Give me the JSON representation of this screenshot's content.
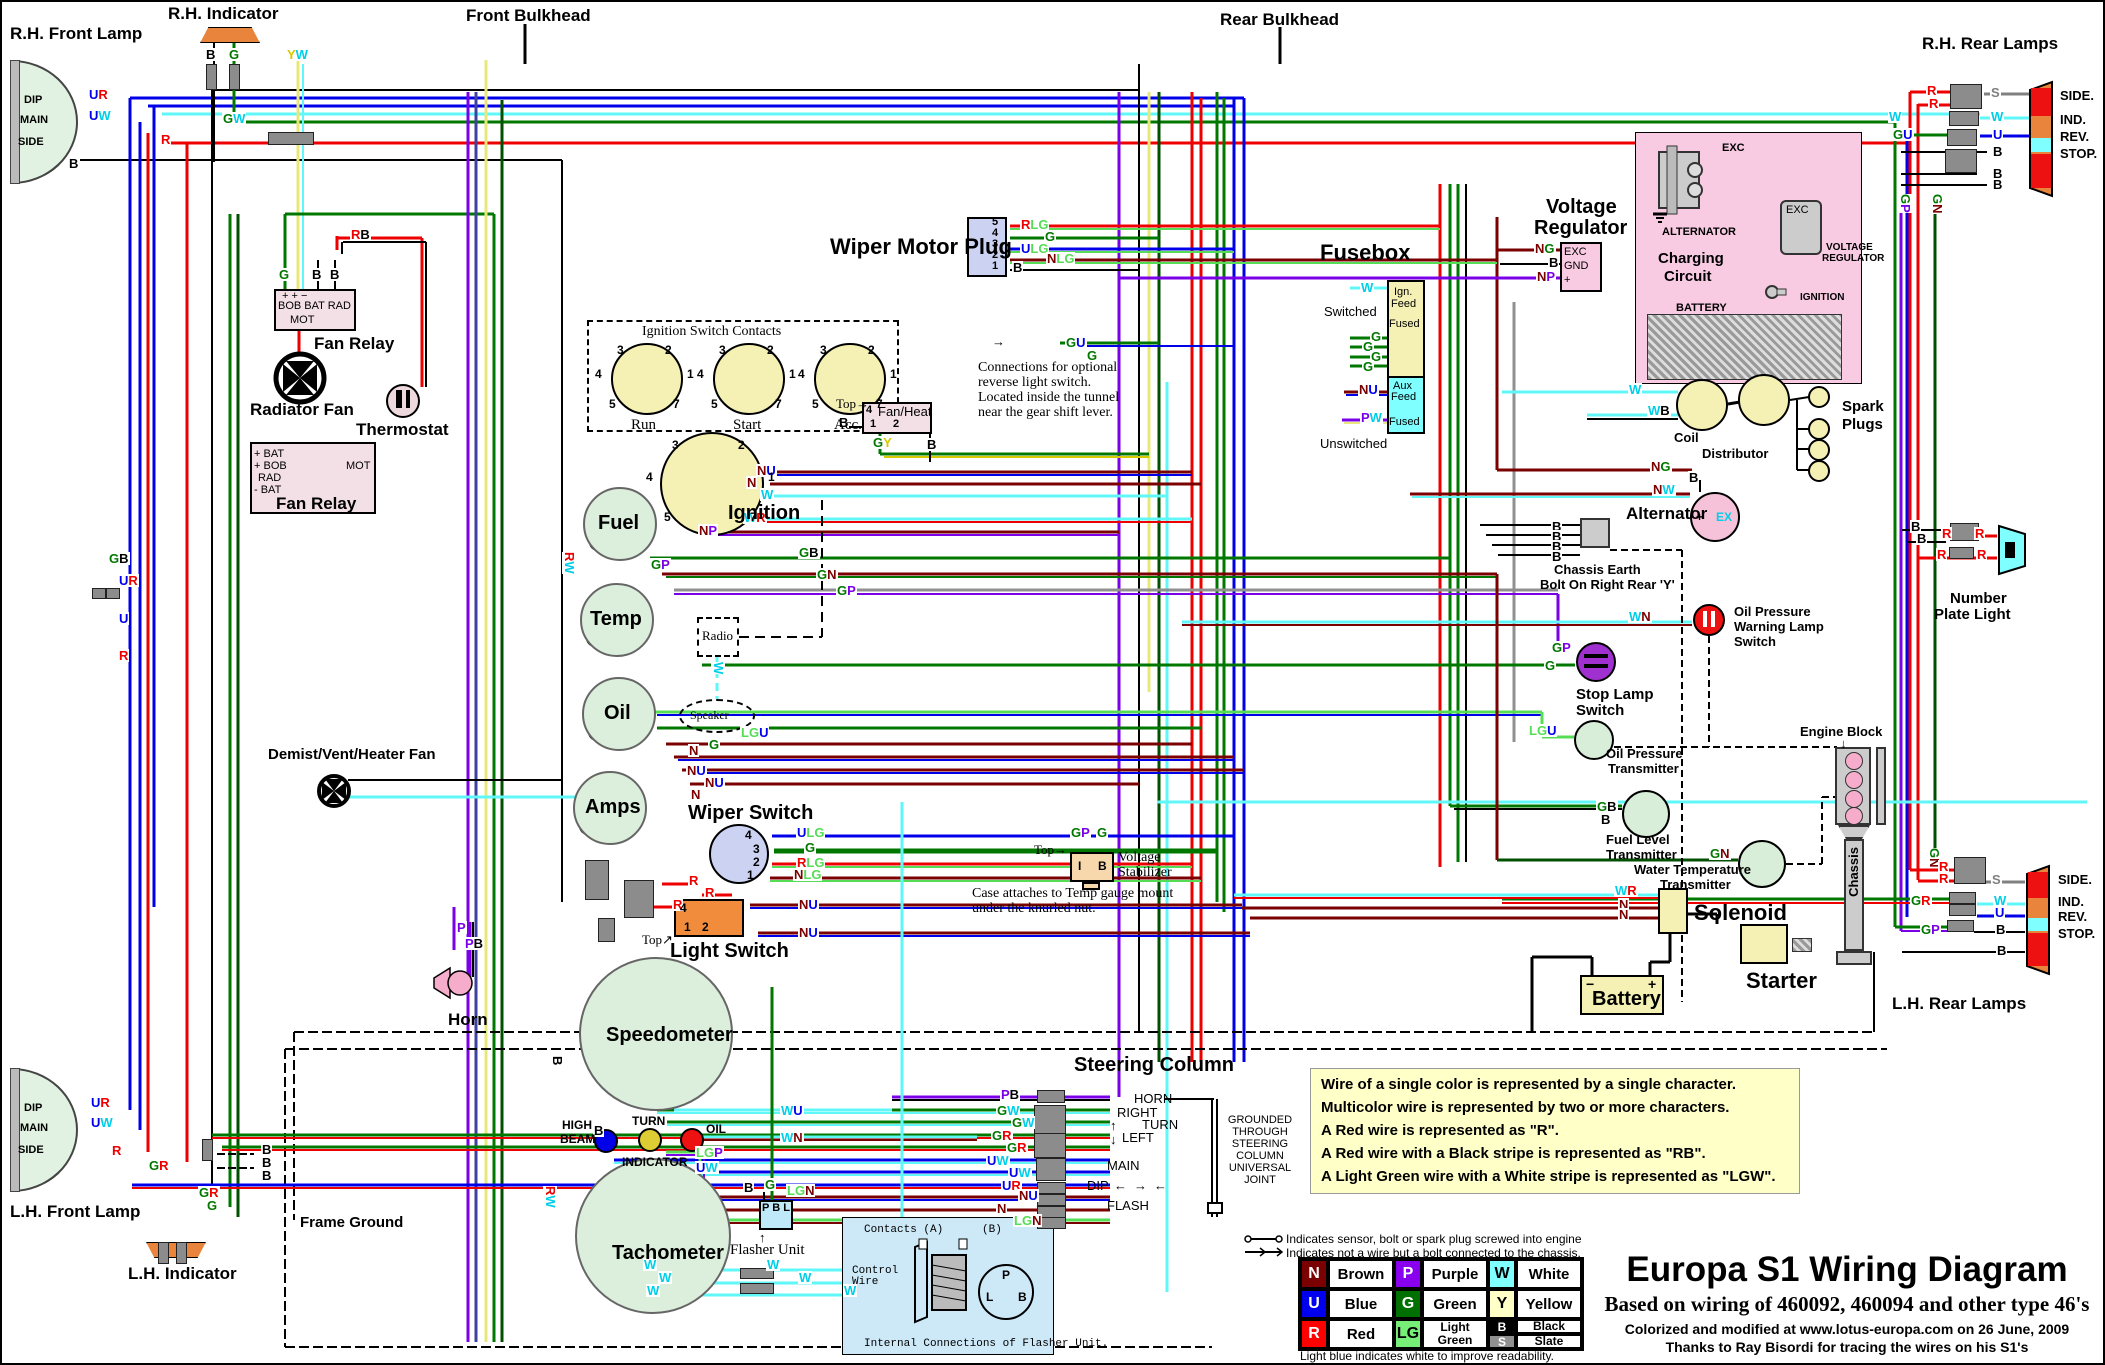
{
  "titles": {
    "main": "Europa S1 Wiring Diagram",
    "sub": "Based on wiring of 460092, 460094 and other type 46's",
    "credit1": "Colorized and modified at www.lotus-europa.com on 26 June, 2009",
    "credit2": "Thanks to Ray Bisordi for tracing the wires on his S1's"
  },
  "notes": {
    "wirebox": [
      "Wire of a single color is represented by a single character.",
      "Multicolor wire is represented by two or more characters.",
      "A Red wire is represented as \"R\".",
      "A Red wire with a Black stripe is represented as \"RB\".",
      "A Light Green wire with a White stripe is represented as \"LGW\"."
    ],
    "legend1": "Indicates sensor, bolt or spark plug screwed into engine",
    "legend2": "Indicates not a wire but a bolt connected to the chassis.",
    "lightblue": "Light blue indicates white to improve readability.",
    "reverse1": "Connections for optional",
    "reverse2": "reverse light switch.",
    "reverse3": "Located inside the tunnel",
    "reverse4": "near the gear shift lever.",
    "stab1": "Case attaches to Temp gauge mount",
    "stab2": "under the knurled nut.",
    "grounded": [
      "GROUNDED",
      "THROUGH",
      "STEERING",
      "COLUMN",
      "UNIVERSAL",
      "JOINT"
    ],
    "flasher_int_title": "Internal Connections of Flasher Unit.",
    "contacts_a": "Contacts (A)",
    "contacts_b": "(B)",
    "control1": "Control",
    "control2": "Wire"
  },
  "legend": {
    "items": [
      {
        "code": "N",
        "name": "Brown",
        "bg": "#7B0000",
        "fg": "#FFFFFF"
      },
      {
        "code": "P",
        "name": "Purple",
        "bg": "#8800EE",
        "fg": "#FFFFFF"
      },
      {
        "code": "W",
        "name": "White",
        "bg": "#7FFFFF",
        "fg": "#000000"
      },
      {
        "code": "U",
        "name": "Blue",
        "bg": "#0000EE",
        "fg": "#FFFFFF"
      },
      {
        "code": "G",
        "name": "Green",
        "bg": "#007000",
        "fg": "#FFFFFF"
      },
      {
        "code": "Y",
        "name": "Yellow",
        "bg": "#FFFFC8",
        "fg": "#000000"
      },
      {
        "code": "R",
        "name": "Red",
        "bg": "#FF0000",
        "fg": "#FFFFFF"
      },
      {
        "code": "LG",
        "name": "Light Green",
        "bg": "#77EE77",
        "fg": "#000000"
      },
      {
        "code": "B",
        "name": "Black",
        "bg": "#000000",
        "fg": "#FFFFFF"
      },
      {
        "code": "S",
        "name": "Slate",
        "bg": "#909090",
        "fg": "#FFFFFF"
      }
    ]
  },
  "components": {
    "rh_front_lamp": "R.H. Front Lamp",
    "lh_front_lamp": "L.H. Front Lamp",
    "rh_indicator": "R.H. Indicator",
    "lh_indicator": "L.H. Indicator",
    "front_bulkhead": "Front Bulkhead",
    "rear_bulkhead": "Rear Bulkhead",
    "rh_rear_lamps": "R.H. Rear Lamps",
    "lh_rear_lamps": "L.H. Rear Lamps",
    "fan_relay": "Fan Relay",
    "radiator_fan": "Radiator Fan",
    "thermostat": "Thermostat",
    "fr_row1": "+   +   −",
    "fr_row2": "BOB BAT  RAD",
    "fr_mot": "MOT",
    "fr2_l1": "+ BAT",
    "fr2_l2": "+ BOB",
    "fr2_l3": "RAD",
    "fr2_l4": "- BAT",
    "fr2_mot": "MOT",
    "fr2_label": "Fan Relay",
    "demist": "Demist/Vent/Heater Fan",
    "horn": "Horn",
    "frame_ground": "Frame Ground",
    "ignition": "Ignition",
    "fuel": "Fuel",
    "temp": "Temp",
    "oil": "Oil",
    "amps": "Amps",
    "radio": "Radio",
    "speaker": "Speaker",
    "wiper_switch": "Wiper Switch",
    "light_switch": "Light Switch",
    "voltage_stab1": "Voltage",
    "voltage_stab2": "Stabilizer",
    "speedometer": "Speedometer",
    "tachometer": "Tachometer",
    "high1": "HIGH",
    "high2": "BEAM",
    "turn": "TURN",
    "oil_ind": "OIL",
    "indicator": "INDICATOR",
    "flasher_unit": "Flasher Unit",
    "wiper_motor_plug": "Wiper Motor Plug",
    "fan_heat": "Fan/Heat",
    "top": "Top",
    "steering_column": "Steering Column",
    "sc_horn": "HORN",
    "sc_right": "RIGHT",
    "sc_turn": "TURN",
    "sc_left": "LEFT",
    "sc_main": "MAIN",
    "sc_dip": "DIP",
    "sc_flash": "FLASH",
    "fusebox": "Fusebox",
    "fb_ign": "Ign.",
    "fb_feed": "Feed",
    "fb_fused": "Fused",
    "fb_aux": "Aux",
    "switched": "Switched",
    "unswitched": "Unswitched",
    "voltage_regulator1": "Voltage",
    "voltage_regulator2": "Regulator",
    "charging1": "Charging",
    "charging2": "Circuit",
    "cc_alternator": "ALTERNATOR",
    "cc_vreg1": "VOLTAGE",
    "cc_vreg2": "REGULATOR",
    "cc_ignition": "IGNITION",
    "cc_battery": "BATTERY",
    "cc_exc": "EXC",
    "coil": "Coil",
    "distributor": "Distributor",
    "spark1": "Spark",
    "spark2": "Plugs",
    "alternator": "Alternator",
    "chassis_earth1": "Chassis Earth",
    "chassis_earth2": "Bolt On Right Rear 'Y'",
    "opw1": "Oil Pressure",
    "opw2": "Warning Lamp",
    "opw3": "Switch",
    "stop1": "Stop Lamp",
    "stop2": "Switch",
    "opt1": "Oil Pressure",
    "opt2": "Transmitter",
    "flt1": "Fuel Level",
    "flt2": "Transmitter",
    "wtt1": "Water Temperature",
    "wtt2": "Transmitter",
    "engine_block": "Engine Block",
    "chassis": "Chassis",
    "solenoid": "Solenoid",
    "starter": "Starter",
    "battery": "Battery",
    "np1": "Number",
    "np2": "Plate Light",
    "lamp_side": "SIDE.",
    "lamp_ind": "IND.",
    "lamp_rev": "REV.",
    "lamp_stop": "STOP."
  },
  "pins": {
    "isc": [
      "3",
      "2",
      "4",
      "1",
      "5",
      "7"
    ],
    "isc_switches": [
      "Run",
      "Start",
      "Acc."
    ],
    "isc_title": "Ignition Switch Contacts",
    "wiper": [
      "4",
      "3",
      "2",
      "1"
    ],
    "light": [
      "4",
      "1",
      "2"
    ],
    "wmp": [
      "5",
      "4",
      "3",
      "2",
      "1"
    ],
    "fanheat": [
      "4",
      "1",
      "2"
    ],
    "stab": [
      "I",
      "B"
    ],
    "flasher": [
      "P",
      "B",
      "L"
    ],
    "flasher_int": [
      "P",
      "L",
      "B"
    ],
    "battery": [
      "−",
      "+"
    ],
    "alt": [
      "+",
      "EX"
    ],
    "vr": [
      "EXC",
      "GND",
      "+"
    ],
    "lamp": [
      "DIP",
      "MAIN",
      "SIDE"
    ]
  },
  "icons": {
    "up": "↑",
    "down": "↓",
    "left": "←",
    "right": "→",
    "ne": "↗",
    "arrow_glyph": "→"
  },
  "wire_colors": {
    "N": "#7B0000",
    "U": "#0000EE",
    "R": "#EE0000",
    "G": "#007800",
    "P": "#7A00E8",
    "W": "#00CFE8",
    "Y": "#D8C800",
    "B": "#000000",
    "S": "#808080",
    "LG": "#55DD55"
  },
  "wire_labels": [
    {
      "t": "UR",
      "x": 86,
      "y": 86
    },
    {
      "t": "UW",
      "x": 86,
      "y": 107
    },
    {
      "t": "R",
      "x": 158,
      "y": 131
    },
    {
      "t": "B",
      "x": 66,
      "y": 155
    },
    {
      "t": "B",
      "x": 203,
      "y": 46
    },
    {
      "t": "G",
      "x": 226,
      "y": 46
    },
    {
      "t": "GW",
      "x": 220,
      "y": 110
    },
    {
      "t": "YW",
      "x": 284,
      "y": 46
    },
    {
      "t": "G",
      "x": 276,
      "y": 266
    },
    {
      "t": "B",
      "x": 309,
      "y": 266
    },
    {
      "t": "B",
      "x": 327,
      "y": 266
    },
    {
      "t": "RB",
      "x": 348,
      "y": 226
    },
    {
      "t": "RLG",
      "x": 1018,
      "y": 216
    },
    {
      "t": "G",
      "x": 1042,
      "y": 228
    },
    {
      "t": "ULG",
      "x": 1018,
      "y": 240
    },
    {
      "t": "NLG",
      "x": 1044,
      "y": 250
    },
    {
      "t": "B",
      "x": 1010,
      "y": 259
    },
    {
      "t": "GU",
      "x": 1063,
      "y": 334
    },
    {
      "t": "G",
      "x": 1084,
      "y": 347
    },
    {
      "t": "B",
      "x": 836,
      "y": 414
    },
    {
      "t": "GY",
      "x": 870,
      "y": 434
    },
    {
      "t": "B",
      "x": 924,
      "y": 436
    },
    {
      "t": "W",
      "x": 1358,
      "y": 279
    },
    {
      "t": "G",
      "x": 1368,
      "y": 328
    },
    {
      "t": "G",
      "x": 1360,
      "y": 338
    },
    {
      "t": "G",
      "x": 1368,
      "y": 348
    },
    {
      "t": "G",
      "x": 1360,
      "y": 358
    },
    {
      "t": "NU",
      "x": 1356,
      "y": 381
    },
    {
      "t": "PW",
      "x": 1358,
      "y": 409
    },
    {
      "t": "NG",
      "x": 1532,
      "y": 240
    },
    {
      "t": "B",
      "x": 1546,
      "y": 254
    },
    {
      "t": "NP",
      "x": 1534,
      "y": 268
    },
    {
      "t": "W",
      "x": 1626,
      "y": 381
    },
    {
      "t": "WB",
      "x": 1645,
      "y": 402
    },
    {
      "t": "NG",
      "x": 1648,
      "y": 458
    },
    {
      "t": "B",
      "x": 1686,
      "y": 469
    },
    {
      "t": "NW",
      "x": 1650,
      "y": 481
    },
    {
      "t": "B",
      "x": 1549,
      "y": 518
    },
    {
      "t": "B",
      "x": 1549,
      "y": 528
    },
    {
      "t": "B",
      "x": 1549,
      "y": 538
    },
    {
      "t": "B",
      "x": 1549,
      "y": 548
    },
    {
      "t": "WN",
      "x": 1626,
      "y": 608
    },
    {
      "t": "GP",
      "x": 1549,
      "y": 639
    },
    {
      "t": "G",
      "x": 1542,
      "y": 657
    },
    {
      "t": "LGU",
      "x": 1526,
      "y": 722
    },
    {
      "t": "GB",
      "x": 1594,
      "y": 798
    },
    {
      "t": "B",
      "x": 1598,
      "y": 811
    },
    {
      "t": "GN",
      "x": 1707,
      "y": 845
    },
    {
      "t": "WR",
      "x": 1612,
      "y": 882
    },
    {
      "t": "N",
      "x": 1616,
      "y": 896
    },
    {
      "t": "N",
      "x": 1616,
      "y": 906
    },
    {
      "t": "B",
      "x": 1908,
      "y": 518
    },
    {
      "t": "B",
      "x": 1914,
      "y": 530
    },
    {
      "t": "R",
      "x": 1939,
      "y": 525
    },
    {
      "t": "R",
      "x": 1972,
      "y": 525
    },
    {
      "t": "R",
      "x": 1934,
      "y": 546
    },
    {
      "t": "R",
      "x": 1974,
      "y": 546
    },
    {
      "t": "R",
      "x": 1924,
      "y": 82
    },
    {
      "t": "R",
      "x": 1926,
      "y": 95
    },
    {
      "t": "S",
      "x": 1988,
      "y": 84
    },
    {
      "t": "W",
      "x": 1886,
      "y": 108
    },
    {
      "t": "W",
      "x": 1988,
      "y": 108
    },
    {
      "t": "GU",
      "x": 1890,
      "y": 126
    },
    {
      "t": "U",
      "x": 1990,
      "y": 126
    },
    {
      "t": "B",
      "x": 1990,
      "y": 143
    },
    {
      "t": "B",
      "x": 1990,
      "y": 165
    },
    {
      "t": "B",
      "x": 1990,
      "y": 176
    },
    {
      "t": "GP",
      "x": 1896,
      "y": 192,
      "v": 1
    },
    {
      "t": "GN",
      "x": 1928,
      "y": 192,
      "v": 1
    },
    {
      "t": "GN",
      "x": 1925,
      "y": 846,
      "v": 1
    },
    {
      "t": "R",
      "x": 1936,
      "y": 858
    },
    {
      "t": "R",
      "x": 1936,
      "y": 870
    },
    {
      "t": "S",
      "x": 1989,
      "y": 871
    },
    {
      "t": "GR",
      "x": 1908,
      "y": 892
    },
    {
      "t": "W",
      "x": 1991,
      "y": 892
    },
    {
      "t": "U",
      "x": 1992,
      "y": 904
    },
    {
      "t": "GP",
      "x": 1918,
      "y": 921
    },
    {
      "t": "B",
      "x": 1993,
      "y": 921
    },
    {
      "t": "B",
      "x": 1994,
      "y": 942
    },
    {
      "t": "UR",
      "x": 88,
      "y": 1094
    },
    {
      "t": "UW",
      "x": 88,
      "y": 1114
    },
    {
      "t": "R",
      "x": 109,
      "y": 1142
    },
    {
      "t": "GR",
      "x": 146,
      "y": 1157
    },
    {
      "t": "B",
      "x": 259,
      "y": 1141
    },
    {
      "t": "B",
      "x": 259,
      "y": 1154
    },
    {
      "t": "B",
      "x": 259,
      "y": 1167
    },
    {
      "t": "GR",
      "x": 196,
      "y": 1184
    },
    {
      "t": "G",
      "x": 204,
      "y": 1197
    },
    {
      "t": "GB",
      "x": 106,
      "y": 550
    },
    {
      "t": "UR",
      "x": 116,
      "y": 572
    },
    {
      "t": "U",
      "x": 116,
      "y": 610
    },
    {
      "t": "R",
      "x": 116,
      "y": 647
    },
    {
      "t": "N",
      "x": 686,
      "y": 742
    },
    {
      "t": "NU",
      "x": 684,
      "y": 762
    },
    {
      "t": "NU",
      "x": 702,
      "y": 774
    },
    {
      "t": "N",
      "x": 688,
      "y": 786
    },
    {
      "t": "P",
      "x": 454,
      "y": 919
    },
    {
      "t": "PB",
      "x": 462,
      "y": 935
    },
    {
      "t": "RW",
      "x": 560,
      "y": 550,
      "v": 1
    },
    {
      "t": "GP",
      "x": 648,
      "y": 556
    },
    {
      "t": "GB",
      "x": 796,
      "y": 544
    },
    {
      "t": "GN",
      "x": 814,
      "y": 566
    },
    {
      "t": "GP",
      "x": 834,
      "y": 582
    },
    {
      "t": "W",
      "x": 709,
      "y": 660,
      "v": 1
    },
    {
      "t": "LGU",
      "x": 738,
      "y": 724
    },
    {
      "t": "G",
      "x": 706,
      "y": 736
    },
    {
      "t": "NU",
      "x": 754,
      "y": 462
    },
    {
      "t": "N",
      "x": 744,
      "y": 474
    },
    {
      "t": "W",
      "x": 758,
      "y": 486
    },
    {
      "t": "WR",
      "x": 741,
      "y": 509
    },
    {
      "t": "NP",
      "x": 696,
      "y": 522
    },
    {
      "t": "ULG",
      "x": 794,
      "y": 824
    },
    {
      "t": "G",
      "x": 802,
      "y": 839
    },
    {
      "t": "RLG",
      "x": 794,
      "y": 854
    },
    {
      "t": "NLG",
      "x": 791,
      "y": 866
    },
    {
      "t": "R",
      "x": 686,
      "y": 872
    },
    {
      "t": "R",
      "x": 702,
      "y": 884
    },
    {
      "t": "R",
      "x": 670,
      "y": 896
    },
    {
      "t": "NU",
      "x": 796,
      "y": 896
    },
    {
      "t": "NU",
      "x": 796,
      "y": 924
    },
    {
      "t": "GP",
      "x": 1068,
      "y": 824
    },
    {
      "t": "G",
      "x": 1094,
      "y": 824
    },
    {
      "t": "B",
      "x": 548,
      "y": 1054,
      "v": 1
    },
    {
      "t": "WU",
      "x": 778,
      "y": 1102
    },
    {
      "t": "WN",
      "x": 778,
      "y": 1129
    },
    {
      "t": "LGP",
      "x": 693,
      "y": 1144
    },
    {
      "t": "UW",
      "x": 693,
      "y": 1159
    },
    {
      "t": "B",
      "x": 591,
      "y": 1122
    },
    {
      "t": "RW",
      "x": 541,
      "y": 1184,
      "v": 1
    },
    {
      "t": "B",
      "x": 741,
      "y": 1179
    },
    {
      "t": "G",
      "x": 762,
      "y": 1176
    },
    {
      "t": "LGN",
      "x": 784,
      "y": 1182
    },
    {
      "t": "W",
      "x": 641,
      "y": 1256
    },
    {
      "t": "W",
      "x": 656,
      "y": 1269
    },
    {
      "t": "W",
      "x": 644,
      "y": 1282
    },
    {
      "t": "W",
      "x": 764,
      "y": 1256
    },
    {
      "t": "W",
      "x": 796,
      "y": 1269
    },
    {
      "t": "W",
      "x": 841,
      "y": 1282
    },
    {
      "t": "PB",
      "x": 998,
      "y": 1086
    },
    {
      "t": "GW",
      "x": 994,
      "y": 1102
    },
    {
      "t": "GW",
      "x": 1009,
      "y": 1114
    },
    {
      "t": "GR",
      "x": 989,
      "y": 1127
    },
    {
      "t": "GR",
      "x": 1004,
      "y": 1139
    },
    {
      "t": "UW",
      "x": 984,
      "y": 1152
    },
    {
      "t": "UW",
      "x": 1006,
      "y": 1164
    },
    {
      "t": "UR",
      "x": 999,
      "y": 1177
    },
    {
      "t": "NU",
      "x": 1016,
      "y": 1187
    },
    {
      "t": "N",
      "x": 994,
      "y": 1200
    },
    {
      "t": "LGN",
      "x": 1011,
      "y": 1212
    }
  ]
}
